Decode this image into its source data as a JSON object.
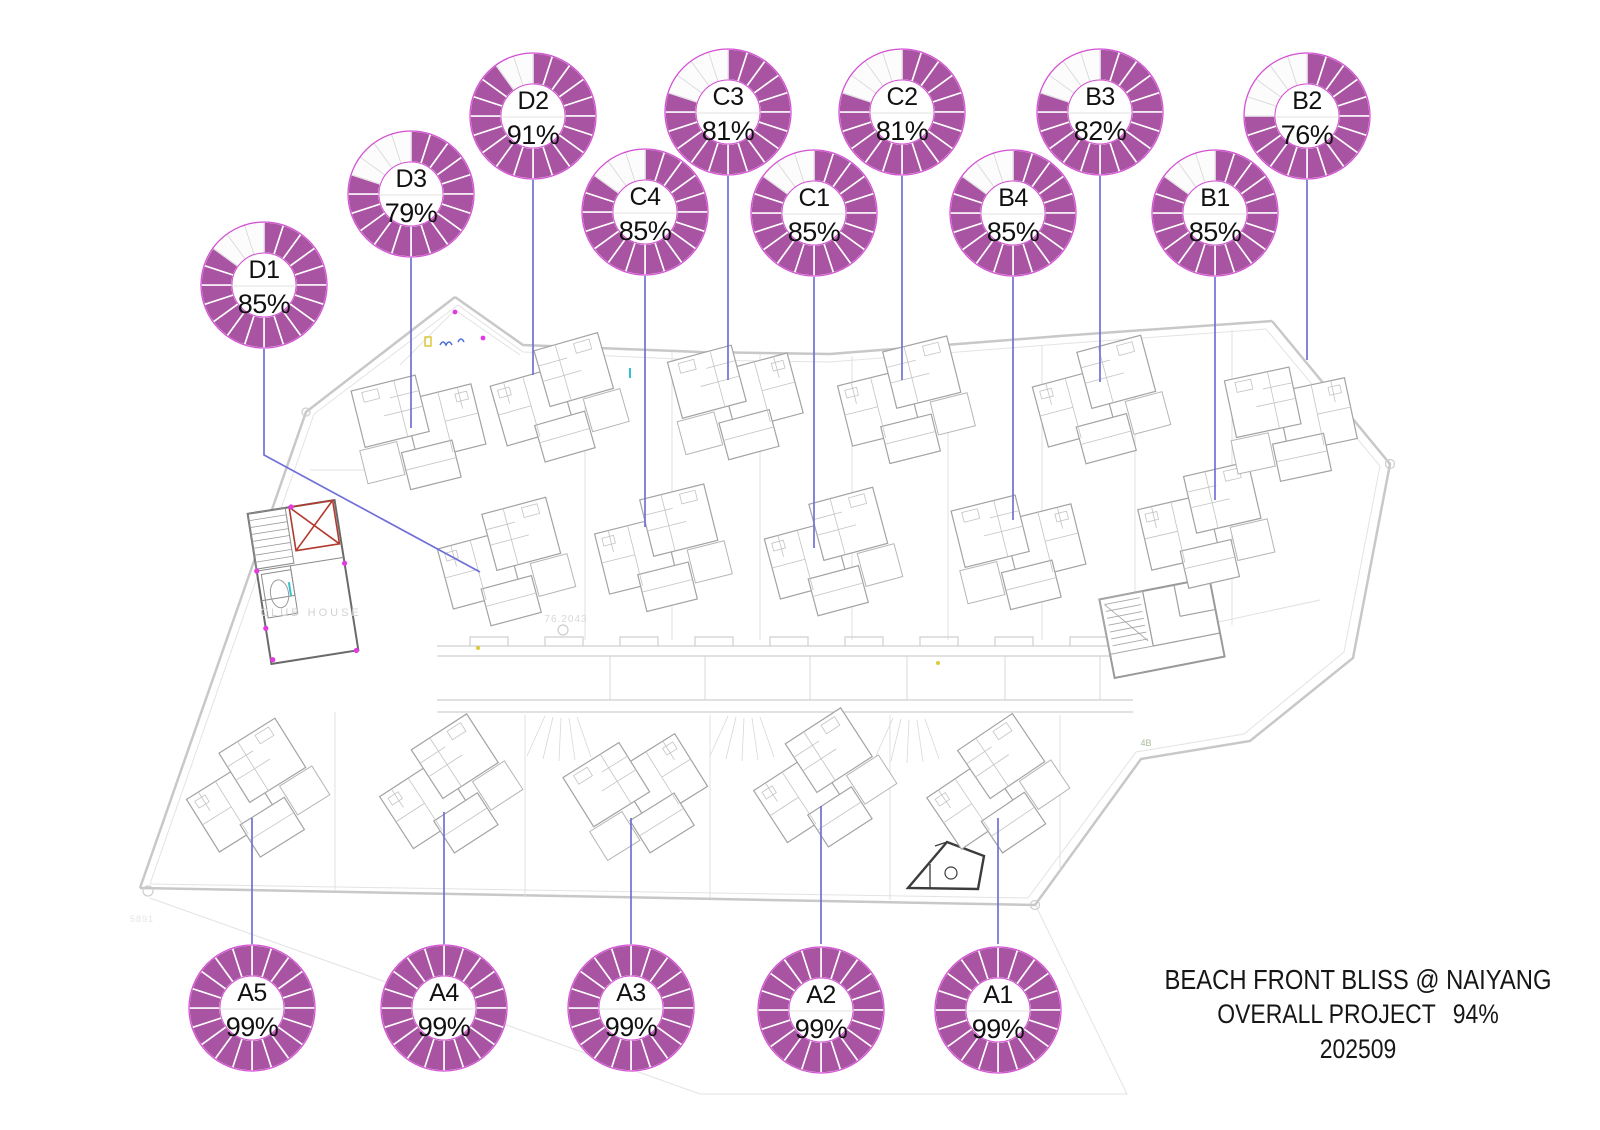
{
  "title_block": {
    "line1": "BEACH FRONT BLISS @ NAIYANG",
    "line2_label": "OVERALL PROJECT",
    "line2_value": "94%",
    "line3": "202509"
  },
  "colors": {
    "donut_fill": "#a954a2",
    "donut_empty": "#fcfcfc",
    "donut_outline": "#d44fd4",
    "empty_divider": "#d9d9d9",
    "filled_divider": "#ffffff",
    "hole_line": "#e2e2e2",
    "leader": "#7070d8",
    "label_text": "#111111",
    "plan_gray": "#c8c8c8",
    "accent_magenta": "#e23ae2",
    "accent_red": "#b23a2e",
    "accent_cyan": "#35c0cf",
    "accent_yellow": "#d8c32e",
    "accent_blue": "#4a6fd8"
  },
  "chart_data": {
    "type": "donut",
    "title": "BEACH FRONT BLISS @ NAIYANG",
    "subtitle": "OVERALL PROJECT 94%",
    "period": "202509",
    "overall_pct": 94,
    "segments_per_ring": 20,
    "value_suffix": "%",
    "units": [
      {
        "id": "D1",
        "pct": 85,
        "cx": 264,
        "cy": 285,
        "leader": [
          [
            264,
            349
          ],
          [
            264,
            455
          ],
          [
            480,
            572
          ]
        ],
        "villa": {
          "x": 505,
          "y": 562,
          "rot": -15,
          "sx": 1
        }
      },
      {
        "id": "D3",
        "pct": 79,
        "cx": 411,
        "cy": 194,
        "leader": [
          [
            411,
            256
          ],
          [
            411,
            428
          ]
        ],
        "villa": {
          "x": 418,
          "y": 428,
          "rot": -14,
          "sx": -1
        }
      },
      {
        "id": "D2",
        "pct": 91,
        "cx": 533,
        "cy": 116,
        "leader": [
          [
            533,
            180
          ],
          [
            533,
            375
          ]
        ],
        "villa": {
          "x": 558,
          "y": 398,
          "rot": -16,
          "sx": 1
        }
      },
      {
        "id": "C4",
        "pct": 85,
        "cx": 645,
        "cy": 212,
        "leader": [
          [
            645,
            276
          ],
          [
            645,
            527
          ]
        ],
        "villa": {
          "x": 662,
          "y": 548,
          "rot": -14,
          "sx": 1
        }
      },
      {
        "id": "C3",
        "pct": 81,
        "cx": 728,
        "cy": 112,
        "leader": [
          [
            728,
            176
          ],
          [
            728,
            380
          ]
        ],
        "villa": {
          "x": 735,
          "y": 398,
          "rot": -15,
          "sx": -1
        }
      },
      {
        "id": "C1",
        "pct": 85,
        "cx": 814,
        "cy": 213,
        "leader": [
          [
            814,
            277
          ],
          [
            814,
            548
          ]
        ],
        "villa": {
          "x": 832,
          "y": 552,
          "rot": -15,
          "sx": 1
        }
      },
      {
        "id": "C2",
        "pct": 81,
        "cx": 902,
        "cy": 112,
        "leader": [
          [
            902,
            176
          ],
          [
            902,
            380
          ]
        ],
        "villa": {
          "x": 905,
          "y": 400,
          "rot": -14,
          "sx": 1
        }
      },
      {
        "id": "B4",
        "pct": 85,
        "cx": 1013,
        "cy": 213,
        "leader": [
          [
            1013,
            277
          ],
          [
            1013,
            520
          ]
        ],
        "villa": {
          "x": 1018,
          "y": 548,
          "rot": -14,
          "sx": -1
        }
      },
      {
        "id": "B3",
        "pct": 82,
        "cx": 1100,
        "cy": 112,
        "leader": [
          [
            1100,
            176
          ],
          [
            1100,
            382
          ]
        ],
        "villa": {
          "x": 1100,
          "y": 400,
          "rot": -15,
          "sx": 1
        }
      },
      {
        "id": "B1",
        "pct": 85,
        "cx": 1215,
        "cy": 213,
        "leader": [
          [
            1215,
            277
          ],
          [
            1215,
            500
          ]
        ],
        "villa": {
          "x": 1205,
          "y": 525,
          "rot": -13,
          "sx": 1
        }
      },
      {
        "id": "B2",
        "pct": 76,
        "cx": 1307,
        "cy": 116,
        "leader": [
          [
            1307,
            180
          ],
          [
            1307,
            360
          ]
        ],
        "villa": {
          "x": 1290,
          "y": 420,
          "rot": -12,
          "sx": -1
        }
      },
      {
        "id": "A5",
        "pct": 99,
        "cx": 252,
        "cy": 1008,
        "leader": [
          [
            252,
            944
          ],
          [
            252,
            818
          ]
        ],
        "villa": {
          "x": 255,
          "y": 792,
          "rot": -32,
          "sx": 1
        }
      },
      {
        "id": "A4",
        "pct": 99,
        "cx": 444,
        "cy": 1008,
        "leader": [
          [
            444,
            944
          ],
          [
            444,
            812
          ]
        ],
        "villa": {
          "x": 448,
          "y": 788,
          "rot": -33,
          "sx": 1
        }
      },
      {
        "id": "A3",
        "pct": 99,
        "cx": 631,
        "cy": 1008,
        "leader": [
          [
            631,
            944
          ],
          [
            631,
            818
          ]
        ],
        "villa": {
          "x": 638,
          "y": 792,
          "rot": -32,
          "sx": -1
        }
      },
      {
        "id": "A2",
        "pct": 99,
        "cx": 821,
        "cy": 1010,
        "leader": [
          [
            821,
            944
          ],
          [
            821,
            806
          ]
        ],
        "villa": {
          "x": 822,
          "y": 782,
          "rot": -33,
          "sx": 1
        }
      },
      {
        "id": "A1",
        "pct": 99,
        "cx": 998,
        "cy": 1010,
        "leader": [
          [
            998,
            944
          ],
          [
            998,
            818
          ]
        ],
        "villa": {
          "x": 995,
          "y": 788,
          "rot": -34,
          "sx": 1
        }
      }
    ]
  },
  "plan": {
    "labels": [
      {
        "text": "CLUB HOUSE",
        "x": 311,
        "y": 616,
        "size": 11,
        "color": "#d2d2d2",
        "ls": 3
      },
      {
        "text": "76.2043",
        "x": 566,
        "y": 622,
        "size": 10,
        "color": "#d8d8d8",
        "ls": 1
      },
      {
        "text": "5891",
        "x": 142,
        "y": 922,
        "size": 9,
        "color": "#e4e4e4",
        "ls": 1
      },
      {
        "text": "4B",
        "x": 1146,
        "y": 746,
        "size": 9,
        "color": "#a9bb99",
        "ls": 0
      }
    ]
  }
}
